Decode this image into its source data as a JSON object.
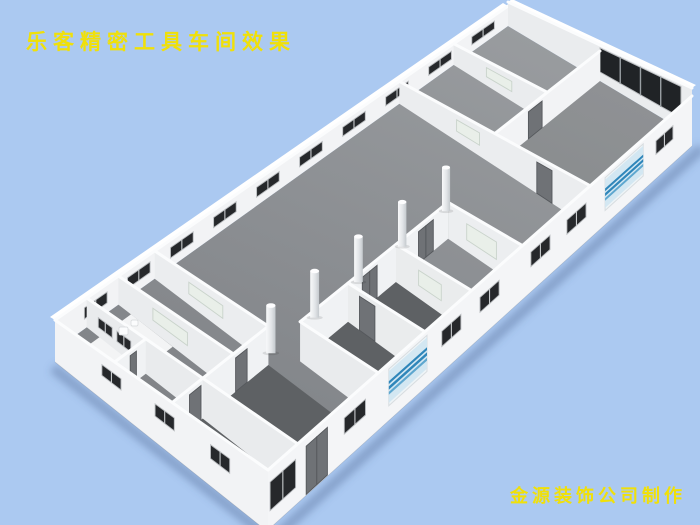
{
  "page": {
    "background_color": "#abc9f1",
    "kind": "3d-architectural-rendering"
  },
  "title": {
    "text": "乐客精密工具车间效果",
    "color": "#f0e009"
  },
  "credit": {
    "text": "金源装饰公司制作",
    "color": "#f0e009"
  },
  "scene": {
    "description": "isometric cutaway rendering of a precision tool workshop interior",
    "palette": {
      "sky": "#abc9f1",
      "floor_light": "#96999c",
      "floor_mid": "#86898c",
      "floor_dark_room": "#5e6164",
      "floor_white_patch": "#f3f4f5",
      "wall_bright": "#f2f3f5",
      "wall_interior": "#eaecee",
      "wall_cap": "#fbfcfd",
      "window_dark": "#26282b",
      "window_frame": "#b9bcbf",
      "door_gray": "#6f7276",
      "door_edge": "#55585c",
      "frosted_window": "#e9efe9",
      "frosted_frame": "#c9d3cb",
      "glass_frame": "#eef4f7",
      "glass_fill": "#d3e7f2",
      "glass_stripe": "#2f86ba",
      "glass_stripe_light": "#5ea7cf",
      "column_light": "#f8f9fa",
      "column_dark": "#c4c9cd",
      "shadow": "rgba(70,95,140,0.38)"
    },
    "columns": {
      "count": 5
    },
    "nw_wall_window_count": 10,
    "ne_wall_window_panels": 4,
    "sw_wall_window_count": 3,
    "se_wall_glass_sections": 2
  }
}
